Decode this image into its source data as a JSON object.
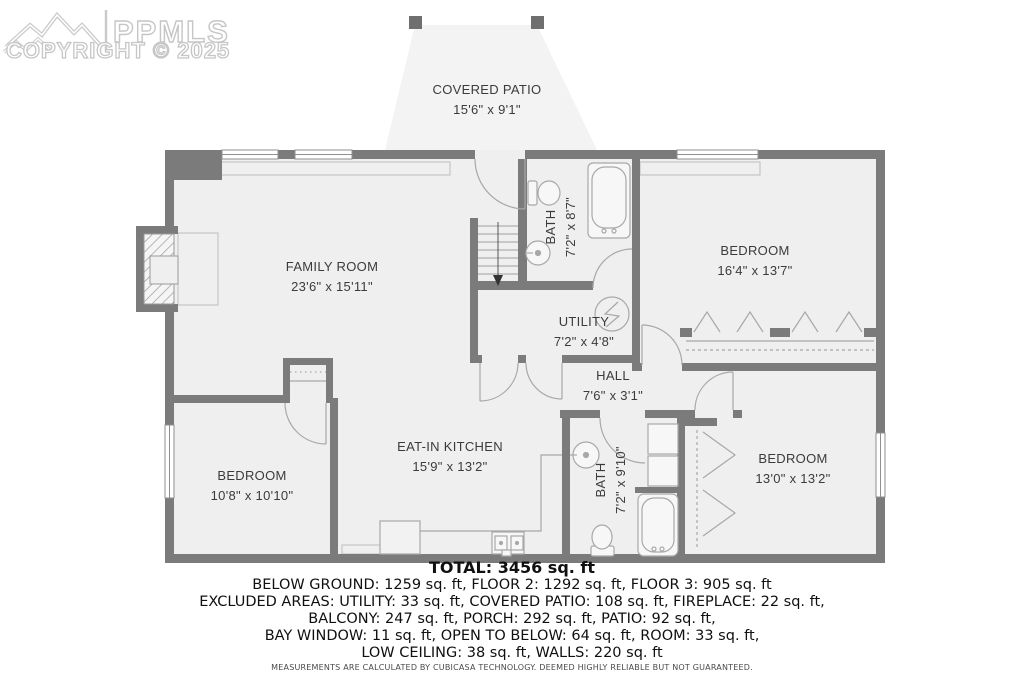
{
  "watermark": {
    "logo_text": "PPMLS",
    "copyright": "COPYRIGHT © 2025"
  },
  "rooms": [
    {
      "id": "covered-patio",
      "name": "COVERED PATIO",
      "dims": "15'6\" x 9'1\""
    },
    {
      "id": "family-room",
      "name": "FAMILY ROOM",
      "dims": "23'6\" x 15'11\""
    },
    {
      "id": "bath-upper",
      "name": "BATH",
      "dims": "7'2\" x 8'7\""
    },
    {
      "id": "bedroom-top-right",
      "name": "BEDROOM",
      "dims": "16'4\" x 13'7\""
    },
    {
      "id": "utility",
      "name": "UTILITY",
      "dims": "7'2\" x 4'8\""
    },
    {
      "id": "hall",
      "name": "HALL",
      "dims": "7'6\" x 3'1\""
    },
    {
      "id": "eat-in-kitchen",
      "name": "EAT-IN KITCHEN",
      "dims": "15'9\" x 13'2\""
    },
    {
      "id": "bedroom-bottom-left",
      "name": "BEDROOM",
      "dims": "10'8\" x 10'10\""
    },
    {
      "id": "bath-lower",
      "name": "BATH",
      "dims": "7'2\" x 9'10\""
    },
    {
      "id": "bedroom-bottom-right",
      "name": "BEDROOM",
      "dims": "13'0\" x 13'2\""
    }
  ],
  "summary": {
    "total": "TOTAL: 3456 sq. ft",
    "line1": "BELOW GROUND: 1259 sq. ft, FLOOR 2: 1292 sq. ft, FLOOR 3: 905 sq. ft",
    "line2": "EXCLUDED AREAS: UTILITY: 33 sq. ft, COVERED PATIO: 108 sq. ft, FIREPLACE: 22 sq. ft,",
    "line3": "BALCONY: 247 sq. ft, PORCH: 292 sq. ft, PATIO: 92 sq. ft,",
    "line4": "BAY WINDOW: 11 sq. ft, OPEN TO BELOW: 64 sq. ft, ROOM: 33 sq. ft,",
    "line5": "LOW CEILING: 38 sq. ft, WALLS: 220 sq. ft",
    "disclaimer": "MEASUREMENTS ARE CALCULATED BY CUBICASA TECHNOLOGY. DEEMED HIGHLY RELIABLE BUT NOT GUARANTEED."
  },
  "colors": {
    "wall": "#7b7b7b",
    "room_fill": "#efefef",
    "patio_fill": "#f3f3f3",
    "fixture_stroke": "#a8a8a8",
    "label_text": "#3b3b3b",
    "watermark": "#c6c6c6"
  }
}
